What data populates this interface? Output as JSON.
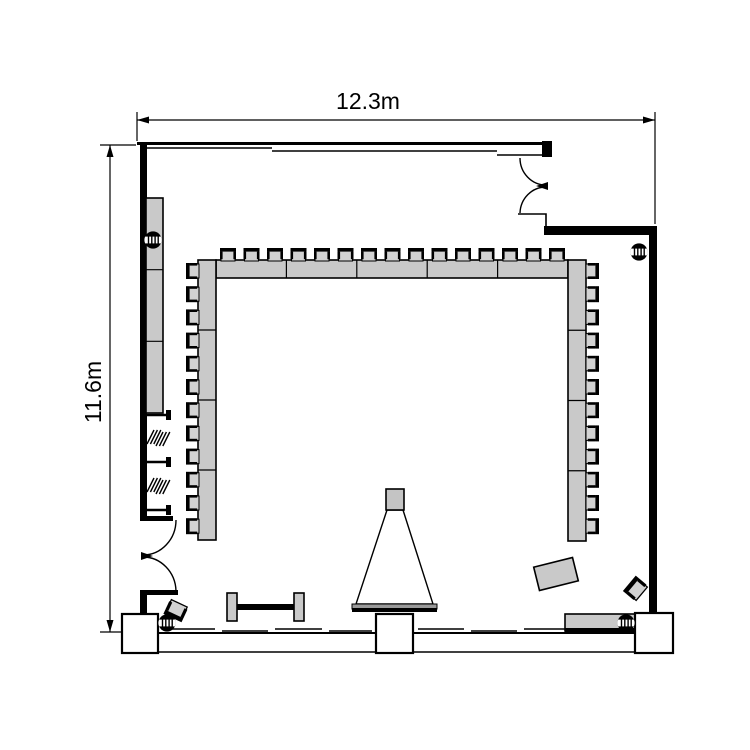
{
  "page": {
    "type": "meeting-room-floor-plan",
    "background": "#ffffff"
  },
  "dimensions": {
    "width_label": "12.3m",
    "depth_label": "11.6m"
  },
  "colors": {
    "wall": "#000000",
    "furniture": "#c9c9c9",
    "chair": "#d2d2d2",
    "screen_bar": "#9a9a9a",
    "projector": "#c4c4c4",
    "background": "#ffffff"
  },
  "seating": {
    "arrangement": "U-shape",
    "top_chairs": 15,
    "left_chairs": 12,
    "right_chairs": 12
  },
  "tables": {
    "top_segments": 5,
    "left_segments": 4,
    "right_segments": 4,
    "side_counter_segments": 3
  },
  "fixtures": {
    "column_markers": 4,
    "wall_columns": 3,
    "double_doors": 2,
    "shelf_brackets": 3,
    "screen": "projection-screen",
    "projector": "projector",
    "bench": "folding-table",
    "loose_tables": 2,
    "loose_chairs": 2
  }
}
